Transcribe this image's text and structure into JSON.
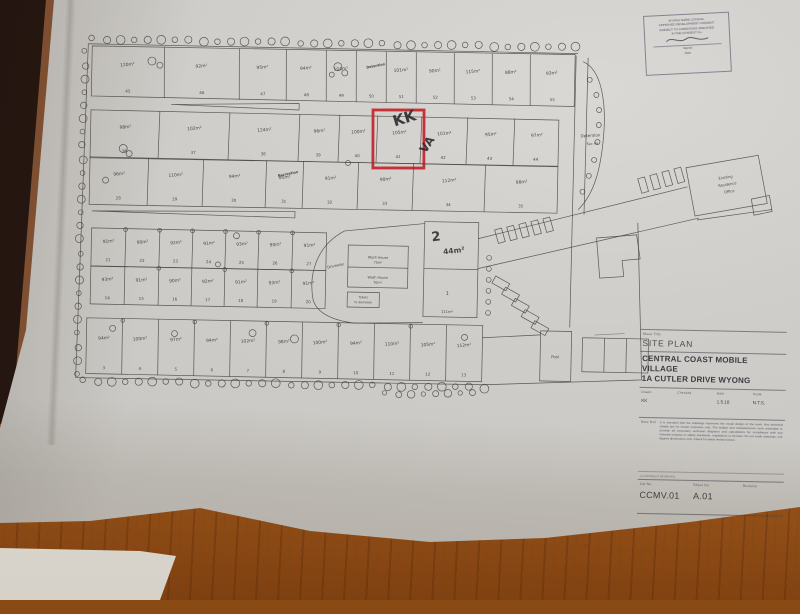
{
  "stamp": {
    "lines": [
      "WYONG SHIRE COUNCIL",
      "APPROVED DEVELOPMENT CONSENT",
      "SUBJECT TO CONDITIONS SPECIFIED",
      "IN THE CONSENT No.",
      "Signed",
      "Date"
    ]
  },
  "title_block": {
    "sheet_title_label": "Sheet Title",
    "sheet_title": "SITE PLAN",
    "project_line1": "CENTRAL COAST MOBILE VILLAGE",
    "project_line2": "1A CUTLER DRIVE WYONG",
    "fields": [
      {
        "label": "Drawn",
        "value": "KK"
      },
      {
        "label": "Checked",
        "value": ""
      },
      {
        "label": "Date",
        "value": "1.5.18"
      },
      {
        "label": "Scale",
        "value": "N.T.S."
      }
    ],
    "note_label": "Note Ref",
    "note_text": "It is intended that the drawings represent the visual design of the work. Any technical details are for tender purposes only. The builder and manufacturers must undertake to provide all necessary technical diagrams and calculations for compliance with any relevant industry or safety standards, regulations or by-laws. Do not scale drawings, use figured dimensions only. Check for latest revision issue.",
    "copyright": "© COPYRIGHT RESERVED",
    "ids": [
      {
        "label": "Job No",
        "value": "CCMV.01"
      },
      {
        "label": "Sheet No",
        "value": "A.01"
      },
      {
        "label": "Revision",
        "value": ""
      }
    ]
  },
  "annotations": {
    "marker_initials": "KK",
    "marker_va": "VA",
    "highlight_color": "#c3232a"
  },
  "site_plan": {
    "rows": [
      {
        "name": "north-row",
        "lots": [
          {
            "area": "120m²",
            "num": "45"
          },
          {
            "area": "92m²",
            "num": "46"
          },
          {
            "area": "95m²",
            "num": "47"
          },
          {
            "area": "94m²",
            "num": "48"
          },
          {
            "area": "104m²",
            "num": "49"
          },
          {
            "area": "",
            "num": "50",
            "note": "Detention"
          },
          {
            "area": "101m²",
            "num": "51"
          },
          {
            "area": "90m²",
            "num": "52"
          },
          {
            "area": "115m²",
            "num": "53"
          },
          {
            "area": "88m²",
            "num": "54"
          },
          {
            "area": "93m²",
            "num": "55"
          }
        ]
      },
      {
        "name": "upper-mid-row",
        "lots": [
          {
            "area": "98m²",
            "num": "36"
          },
          {
            "area": "102m²",
            "num": "37"
          },
          {
            "area": "124m²",
            "num": "38"
          },
          {
            "area": "96m²",
            "num": "39"
          },
          {
            "area": "100m²",
            "num": "40"
          },
          {
            "area": "105m²",
            "num": "41",
            "highlight": true
          },
          {
            "area": "101m²",
            "num": "42"
          },
          {
            "area": "95m²",
            "num": "43"
          },
          {
            "area": "97m²",
            "num": "44"
          }
        ]
      },
      {
        "name": "lower-mid-row",
        "lots": [
          {
            "area": "96m²",
            "num": "28"
          },
          {
            "area": "110m²",
            "num": "29"
          },
          {
            "area": "94m²",
            "num": "30"
          },
          {
            "area": "85m²",
            "num": "31",
            "note": "Recreation"
          },
          {
            "area": "91m²",
            "num": "32"
          },
          {
            "area": "90m²",
            "num": "33"
          },
          {
            "area": "112m²",
            "num": "34"
          },
          {
            "area": "98m²",
            "num": "35"
          }
        ]
      },
      {
        "name": "centre-block-upper",
        "lots": [
          {
            "area": "91m²",
            "num": "21"
          },
          {
            "area": "90m²",
            "num": "22"
          },
          {
            "area": "92m²",
            "num": "23"
          },
          {
            "area": "91m²",
            "num": "24"
          },
          {
            "area": "93m²",
            "num": "25"
          },
          {
            "area": "90m²",
            "num": "26"
          },
          {
            "area": "91m²",
            "num": "27"
          }
        ]
      },
      {
        "name": "centre-block-lower",
        "lots": [
          {
            "area": "93m²",
            "num": "14"
          },
          {
            "area": "91m²",
            "num": "15"
          },
          {
            "area": "90m²",
            "num": "16"
          },
          {
            "area": "92m²",
            "num": "17"
          },
          {
            "area": "91m²",
            "num": "18"
          },
          {
            "area": "93m²",
            "num": "19"
          },
          {
            "area": "91m²",
            "num": "20"
          }
        ]
      },
      {
        "name": "south-row",
        "lots": [
          {
            "area": "94m²",
            "num": "3"
          },
          {
            "area": "100m²",
            "num": "4"
          },
          {
            "area": "97m²",
            "num": "5"
          },
          {
            "area": "94m²",
            "num": "6"
          },
          {
            "area": "102m²",
            "num": "7"
          },
          {
            "area": "98m²",
            "num": "8"
          },
          {
            "area": "100m²",
            "num": "9"
          },
          {
            "area": "94m²",
            "num": "10"
          },
          {
            "area": "110m²",
            "num": "11"
          },
          {
            "area": "105m²",
            "num": "12"
          },
          {
            "area": "112m²",
            "num": "13"
          }
        ]
      }
    ],
    "labels": {
      "driveway": "Driveway",
      "detention_side": "Detention",
      "detention_sub": "Sec 94",
      "wash1_name": "Wash House",
      "wash1_area": "75m²",
      "wash2_name": "Wash House",
      "wash2_area": "70m²",
      "toilets1": "Toilets",
      "toilets2": "to demolish",
      "lot2_num": "2",
      "lot2_area": "44m²",
      "lot1_num": "1",
      "lot1_area": "111m²",
      "pool": "Pool",
      "office1": "Existing",
      "office2": "Residence",
      "office3": "Office"
    }
  }
}
